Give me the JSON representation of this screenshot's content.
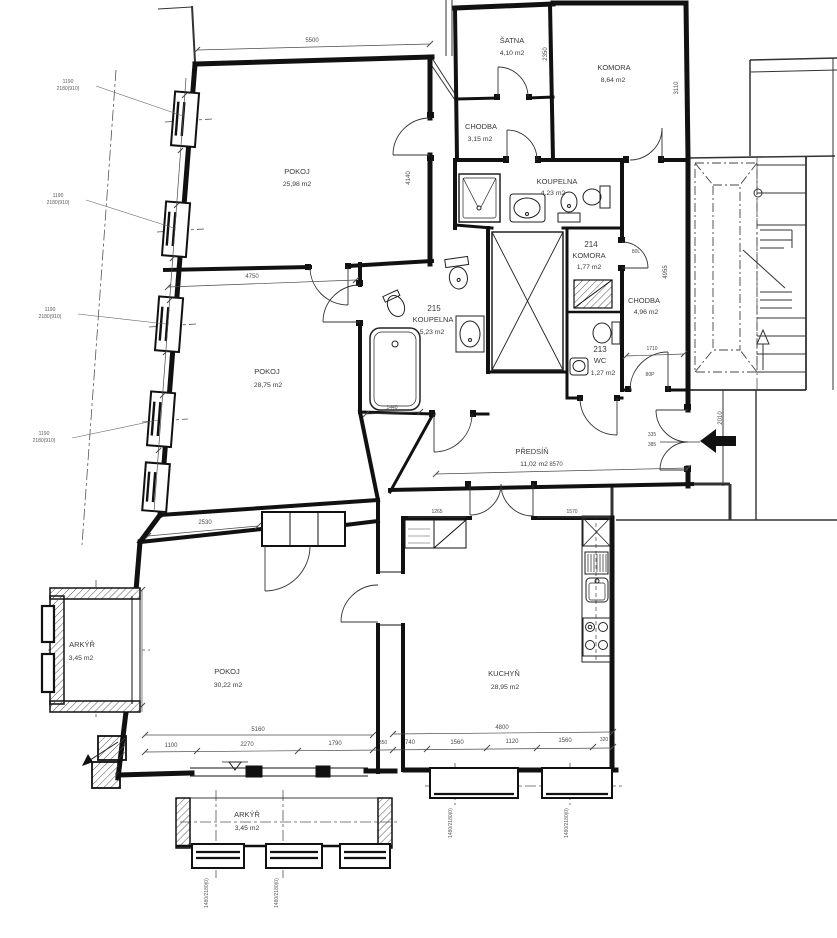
{
  "rooms": {
    "pokoj1": {
      "name": "POKOJ",
      "area": "25,98 m2"
    },
    "pokoj2": {
      "name": "POKOJ",
      "area": "28,75 m2"
    },
    "pokoj3": {
      "name": "POKOJ",
      "area": "30,22 m2"
    },
    "kuchyn": {
      "name": "KUCHYŇ",
      "area": "28,95 m2"
    },
    "predsin": {
      "name": "PŘEDSÍŇ",
      "area": "11,02 m2"
    },
    "koupelna_horni": {
      "name": "KOUPELNA",
      "area": "4,23 m2"
    },
    "koupelna_215": {
      "number": "215",
      "name": "KOUPELNA",
      "area": "5,23 m2"
    },
    "komora_214": {
      "number": "214",
      "name": "KOMORA",
      "area": "1,77 m2"
    },
    "wc_213": {
      "number": "213",
      "name": "WC",
      "area": "1,27 m2"
    },
    "chodba_stredni": {
      "name": "CHODBA",
      "area": "4,96 m2"
    },
    "chodba_horni": {
      "name": "CHODBA",
      "area": "3,15 m2"
    },
    "satna": {
      "name": "ŠATNA",
      "area": "4,10 m2"
    },
    "komora_horni": {
      "name": "KOMORA",
      "area": "8,64 m2"
    },
    "arkyr_levy": {
      "name": "ARKÝŘ",
      "area": "3,45 m2"
    },
    "arkyr_dolni": {
      "name": "ARKÝŘ",
      "area": "3,45 m2"
    }
  },
  "dims": {
    "d5160": "5160",
    "d4800": "4800",
    "d1100": "1100",
    "d2270": "2270",
    "d1790": "1790",
    "d350": "350",
    "d740": "740",
    "d1560a": "1560",
    "d1120": "1120",
    "d1560b": "1560",
    "d320": "320",
    "d8570": "8570",
    "d5500": "5500",
    "d4750": "4750",
    "d2530": "2530",
    "d4140": "4140",
    "d1440": "1440",
    "d1265": "1265",
    "d1570": "1570",
    "d3110": "3110",
    "d2350": "2350",
    "d4955": "4955",
    "d1710": "1710",
    "d2010": "2010",
    "d335": "335",
    "d385": "385",
    "d80l": "80L",
    "d80p": "80P"
  },
  "callouts": {
    "side_w": "1190",
    "side_h": "2180(910)",
    "bottom_wh": "1480/2180(0)"
  }
}
